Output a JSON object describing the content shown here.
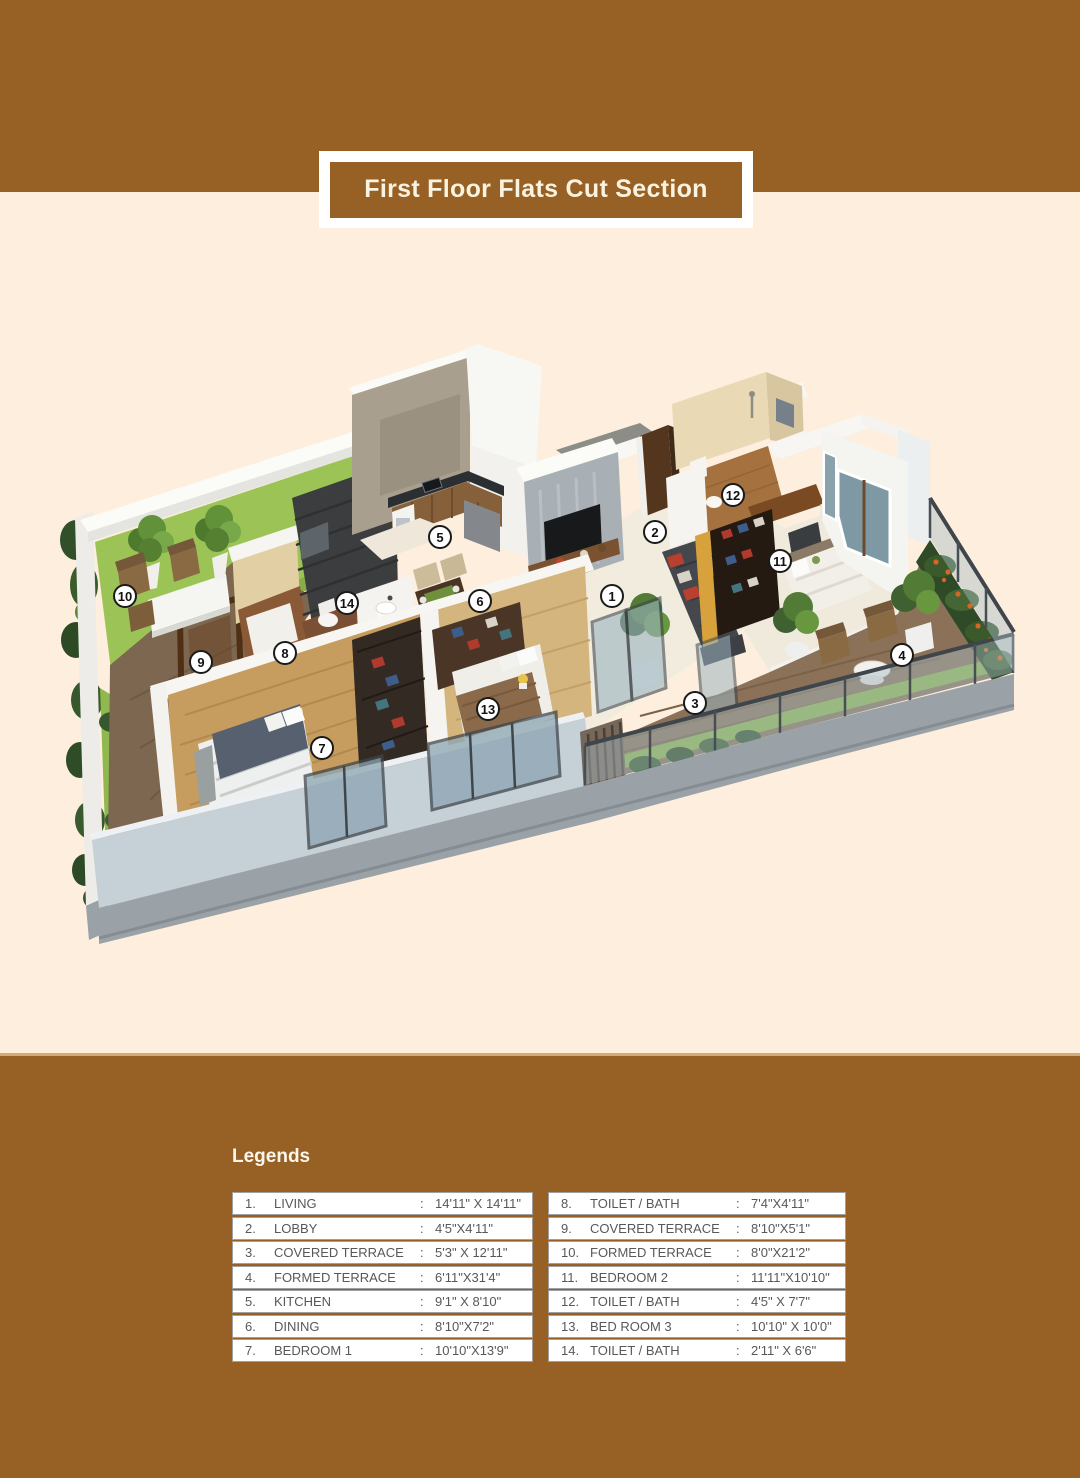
{
  "title": "First Floor Flats Cut Section",
  "legends": {
    "heading": "Legends",
    "left": [
      {
        "num": "1.",
        "name": "LIVING",
        "colon": ":",
        "dim": "14'11\" X 14'11\""
      },
      {
        "num": "2.",
        "name": "LOBBY",
        "colon": ":",
        "dim": "4'5\"X4'11\""
      },
      {
        "num": "3.",
        "name": "COVERED TERRACE",
        "colon": ":",
        "dim": "5'3\" X 12'11\""
      },
      {
        "num": "4.",
        "name": "FORMED TERRACE",
        "colon": ":",
        "dim": "6'11\"X31'4\""
      },
      {
        "num": "5.",
        "name": "KITCHEN",
        "colon": ":",
        "dim": "9'1\" X 8'10\""
      },
      {
        "num": "6.",
        "name": "DINING",
        "colon": ":",
        "dim": "8'10\"X7'2\""
      },
      {
        "num": "7.",
        "name": "BEDROOM 1",
        "colon": ":",
        "dim": "10'10\"X13'9\""
      }
    ],
    "right": [
      {
        "num": "8.",
        "name": "TOILET / BATH",
        "colon": ":",
        "dim": "7'4\"X4'11\""
      },
      {
        "num": "9.",
        "name": "COVERED TERRACE",
        "colon": ":",
        "dim": "8'10\"X5'1\""
      },
      {
        "num": "10.",
        "name": "FORMED TERRACE",
        "colon": ":",
        "dim": "8'0\"X21'2\""
      },
      {
        "num": "11.",
        "name": "BEDROOM 2",
        "colon": ":",
        "dim": "11'11\"X10'10\""
      },
      {
        "num": "12.",
        "name": "TOILET / BATH",
        "colon": ":",
        "dim": "4'5\" X 7'7\""
      },
      {
        "num": "13.",
        "name": "BED ROOM 3",
        "colon": ":",
        "dim": "10'10\" X 10'0\""
      },
      {
        "num": "14.",
        "name": "TOILET / BATH",
        "colon": ":",
        "dim": "2'11\" X 6'6\""
      }
    ]
  },
  "plan": {
    "markers": [
      {
        "label": "1"
      },
      {
        "label": "2"
      },
      {
        "label": "3"
      },
      {
        "label": "4"
      },
      {
        "label": "5"
      },
      {
        "label": "6"
      },
      {
        "label": "7"
      },
      {
        "label": "8"
      },
      {
        "label": "9"
      },
      {
        "label": "10"
      },
      {
        "label": "11"
      },
      {
        "label": "12"
      },
      {
        "label": "13"
      },
      {
        "label": "14"
      }
    ]
  },
  "colors": {
    "band": "#976125",
    "background": "#fdeede",
    "banner_text": "#faf3e0",
    "marker_ring": "#1a1a1a"
  }
}
